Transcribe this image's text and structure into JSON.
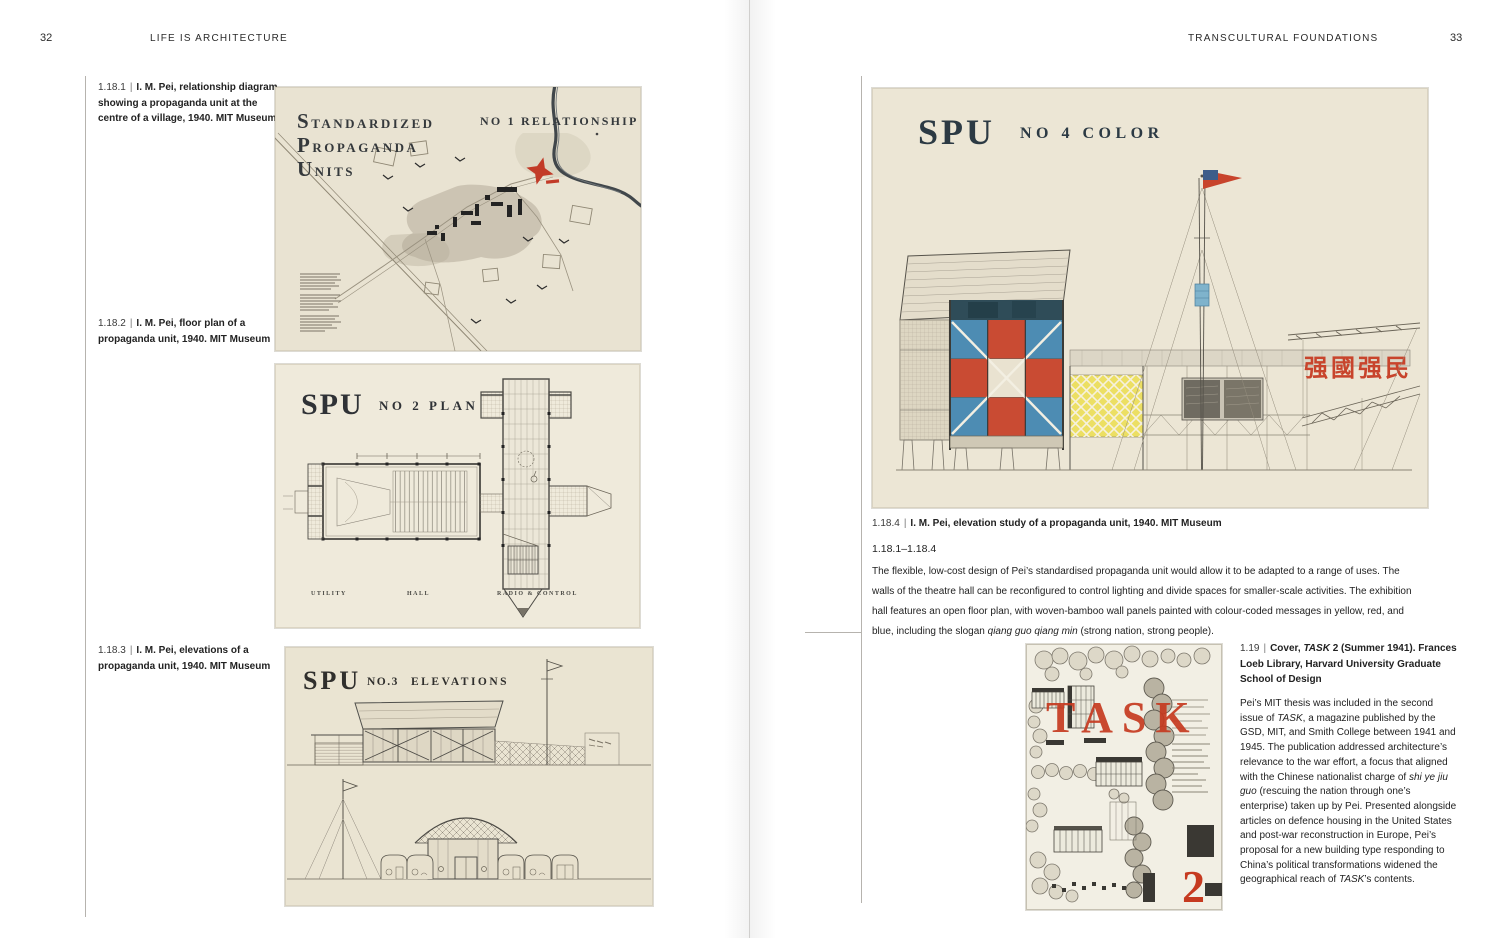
{
  "page": {
    "left": {
      "number": "32",
      "running_head": "LIFE IS ARCHITECTURE"
    },
    "right": {
      "number": "33",
      "running_head": "TRANSCULTURAL FOUNDATIONS"
    }
  },
  "captions": {
    "c1": {
      "number": "1.18.1",
      "sep": "|",
      "text": "I. M. Pei, relationship diagram showing a propaganda unit at the centre of a village, 1940. MIT Museum"
    },
    "c2": {
      "number": "1.18.2",
      "sep": "|",
      "text": "I. M. Pei, floor plan of a propaganda unit, 1940. MIT Museum"
    },
    "c3": {
      "number": "1.18.3",
      "sep": "|",
      "text": "I. M. Pei, elevations of a propaganda unit, 1940. MIT Museum"
    },
    "c4": {
      "number": "1.18.4",
      "sep": "|",
      "text": "I. M. Pei, elevation study of a propaganda unit, 1940. MIT Museum"
    },
    "c5": {
      "number": "1.19",
      "sep": "|",
      "rich": [
        {
          "t": "Cover, "
        },
        {
          "t": "TASK",
          "i": true
        },
        {
          "t": " 2 (Summer 1941). Frances Loeb Library, Harvard University Graduate School of Design"
        }
      ]
    }
  },
  "body": {
    "range_heading": "1.18.1–1.18.4",
    "para_118": [
      {
        "t": "The flexible, low-cost design of Pei’s standardised propaganda unit would allow it to be adapted to a range of uses. The walls of the theatre hall can be reconfigured to control lighting and divide spaces for smaller-scale activities. The exhibition hall features an open floor plan, with woven-bamboo wall panels painted with colour-coded messages in yellow, red, and blue, including the slogan "
      },
      {
        "t": "qiang guo qiang min",
        "i": true
      },
      {
        "t": " (strong nation, strong people)."
      }
    ],
    "para_119": [
      {
        "t": "Pei’s MIT thesis was included in the second issue of "
      },
      {
        "t": "TASK",
        "i": true
      },
      {
        "t": ", a magazine published by the GSD, MIT, and Smith College between 1941 and 1945. The publication addressed architecture’s relevance to the war effort, a focus that aligned with the Chinese nationalist charge of "
      },
      {
        "t": "shi ye jiu guo",
        "i": true
      },
      {
        "t": " (rescuing the nation through one’s enterprise) taken up by Pei. Presented alongside articles on defence housing in the United States and post-war reconstruction in Europe, Pei’s proposal for a new building type responding to China’s political transformations widened the geographical reach of "
      },
      {
        "t": "TASK",
        "i": true
      },
      {
        "t": "’s contents."
      }
    ]
  },
  "figures": {
    "fig1": {
      "title": [
        {
          "initial": "S",
          "rest": "TANDARDIZED"
        },
        {
          "initial": "P",
          "rest": "ROPAGANDA"
        },
        {
          "initial": "U",
          "rest": "NITS"
        }
      ],
      "heading": "NO 1 RELATIONSHIP"
    },
    "fig2": {
      "title": "SPU",
      "heading": "NO 2 PLAN",
      "labels": [
        "UTILITY",
        "HALL",
        "RADIO & CONTROL"
      ]
    },
    "fig3": {
      "title": "SPU",
      "heading_no": "NO.3",
      "heading": "ELEVATIONS"
    },
    "fig4": {
      "title": "SPU",
      "heading": "NO 4 COLOR",
      "slogan": "强國强民"
    },
    "task": {
      "masthead": "TASK",
      "issue": "2"
    }
  },
  "colors": {
    "panel_blue": "#4d8cb3",
    "panel_red": "#c94b33",
    "panel_cream": "#e9e2d0",
    "panel_yellow": "#ecdf63",
    "band_navy": "#2f4c58",
    "accent_red": "#c63a20",
    "flag_red": "#c8442c",
    "flag_blue": "#3e5d8a",
    "paper_cream": "#eae4d3",
    "ink": "#35393c"
  }
}
